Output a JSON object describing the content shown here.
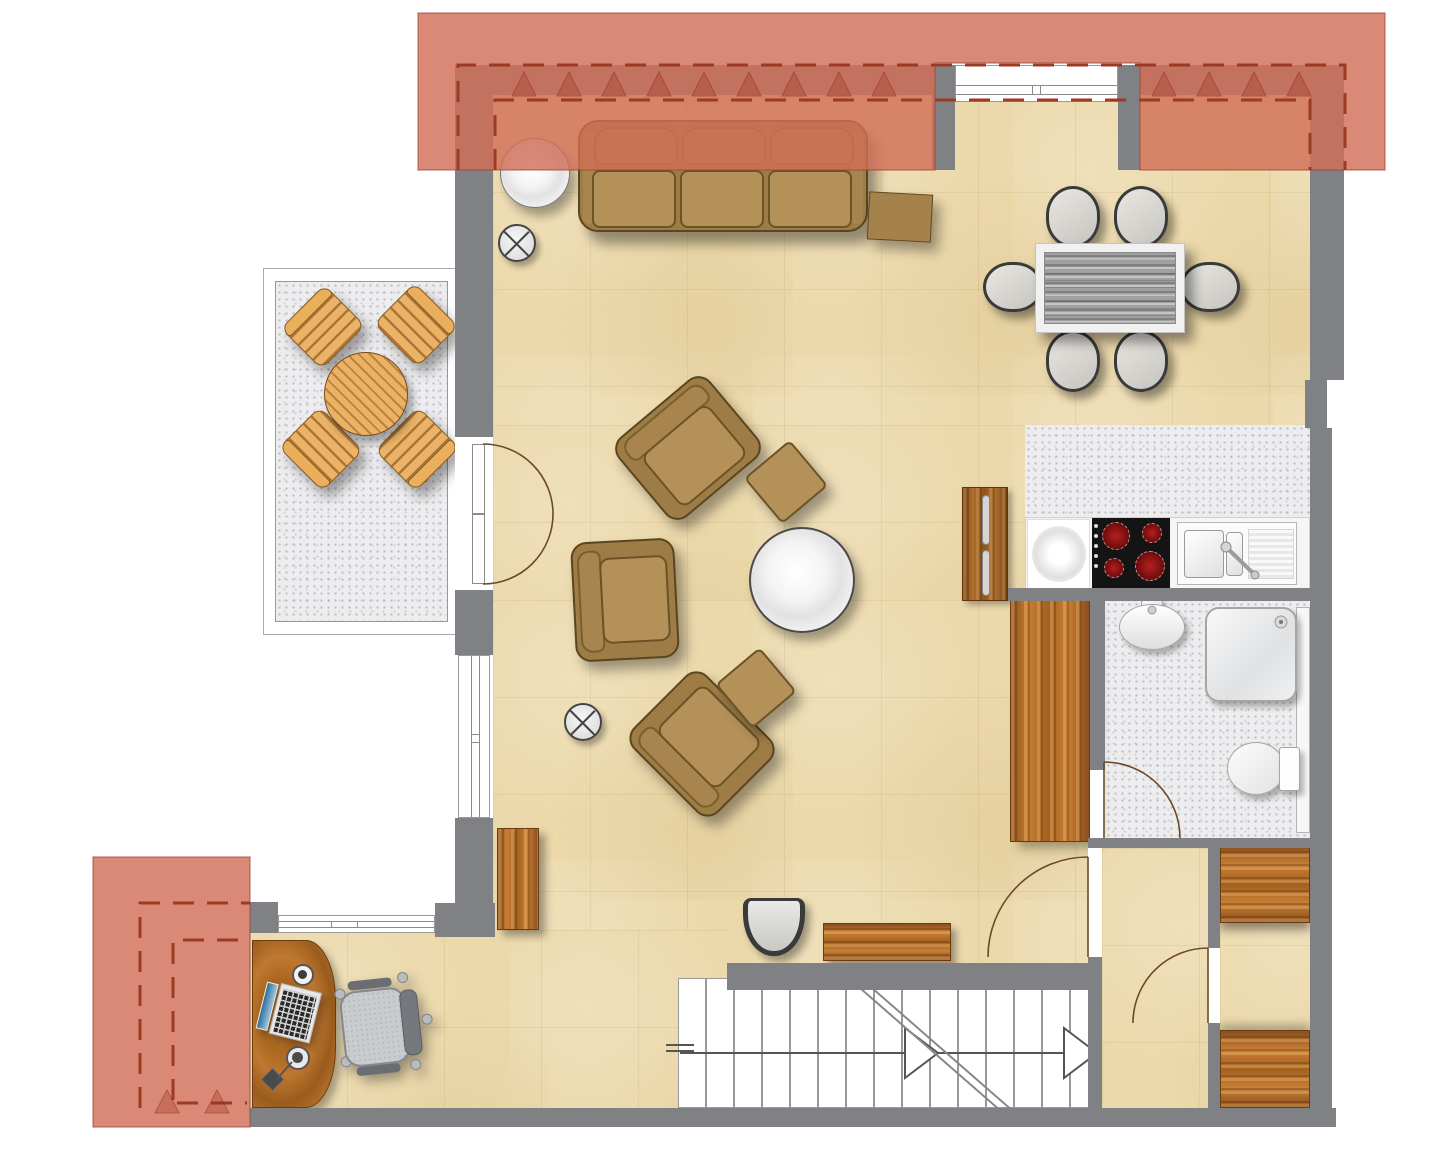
{
  "app": {
    "title": "Apartment floor plan (top-down architectural drawing, no text labels)"
  },
  "canvas": {
    "width": 1440,
    "height": 1155
  },
  "colors": {
    "background": "#ffffff",
    "wall": "#7f8185",
    "floor_beige": "#ecd9ab",
    "floor_speckle": "#ededef",
    "roof": "rgba(209,111,87,0.82)",
    "roof_dash": "#9c3a24",
    "upholstery": "#9d7c46",
    "cushion": "#b5915a",
    "wood": "#c0762e",
    "cooktop": "#141414",
    "burner_red": "#8f1212",
    "stair_line": "#777777",
    "door_arc": "#6b4a2a"
  },
  "rooms": [
    {
      "id": "living-room",
      "floor": "beige tile"
    },
    {
      "id": "dining-area",
      "floor": "beige tile"
    },
    {
      "id": "kitchen",
      "floor": "gray speckle"
    },
    {
      "id": "bathroom",
      "floor": "gray speckle"
    },
    {
      "id": "balcony",
      "floor": "gray speckle"
    },
    {
      "id": "study-nook",
      "floor": "beige tile"
    },
    {
      "id": "stair-landing",
      "floor": "beige tile"
    },
    {
      "id": "storage-room",
      "floor": "beige tile"
    },
    {
      "id": "staircase",
      "floor": "white treads"
    }
  ],
  "furniture": [
    {
      "id": "sofa",
      "seats": 3
    },
    {
      "id": "round-side-table"
    },
    {
      "id": "cross-base-table-1"
    },
    {
      "id": "cross-base-table-2"
    },
    {
      "id": "armchair-1"
    },
    {
      "id": "armchair-2"
    },
    {
      "id": "armchair-3"
    },
    {
      "id": "ottoman-1"
    },
    {
      "id": "ottoman-2"
    },
    {
      "id": "square-side-table"
    },
    {
      "id": "coffee-table"
    },
    {
      "id": "dining-table"
    },
    {
      "id": "dining-chair",
      "count": 6
    },
    {
      "id": "balcony-table"
    },
    {
      "id": "balcony-chair",
      "count": 4
    },
    {
      "id": "kitchen-counter"
    },
    {
      "id": "hob",
      "burners": 4
    },
    {
      "id": "kitchen-sink"
    },
    {
      "id": "kitchen-cabinet"
    },
    {
      "id": "tall-cabinet"
    },
    {
      "id": "pedestal-sink"
    },
    {
      "id": "shower"
    },
    {
      "id": "toilet"
    },
    {
      "id": "wardrobe-cabinet",
      "count": 2
    },
    {
      "id": "sideboard"
    },
    {
      "id": "tub-chair"
    },
    {
      "id": "desk"
    },
    {
      "id": "laptop"
    },
    {
      "id": "desk-lamp"
    },
    {
      "id": "office-chair"
    },
    {
      "id": "mug"
    }
  ],
  "doors": [
    {
      "id": "balcony-french-door",
      "type": "double"
    },
    {
      "id": "bathroom-door",
      "type": "single"
    },
    {
      "id": "landing-door",
      "type": "single"
    },
    {
      "id": "storage-door",
      "type": "single"
    }
  ],
  "stairs": {
    "treads": 15,
    "direction": "right"
  }
}
